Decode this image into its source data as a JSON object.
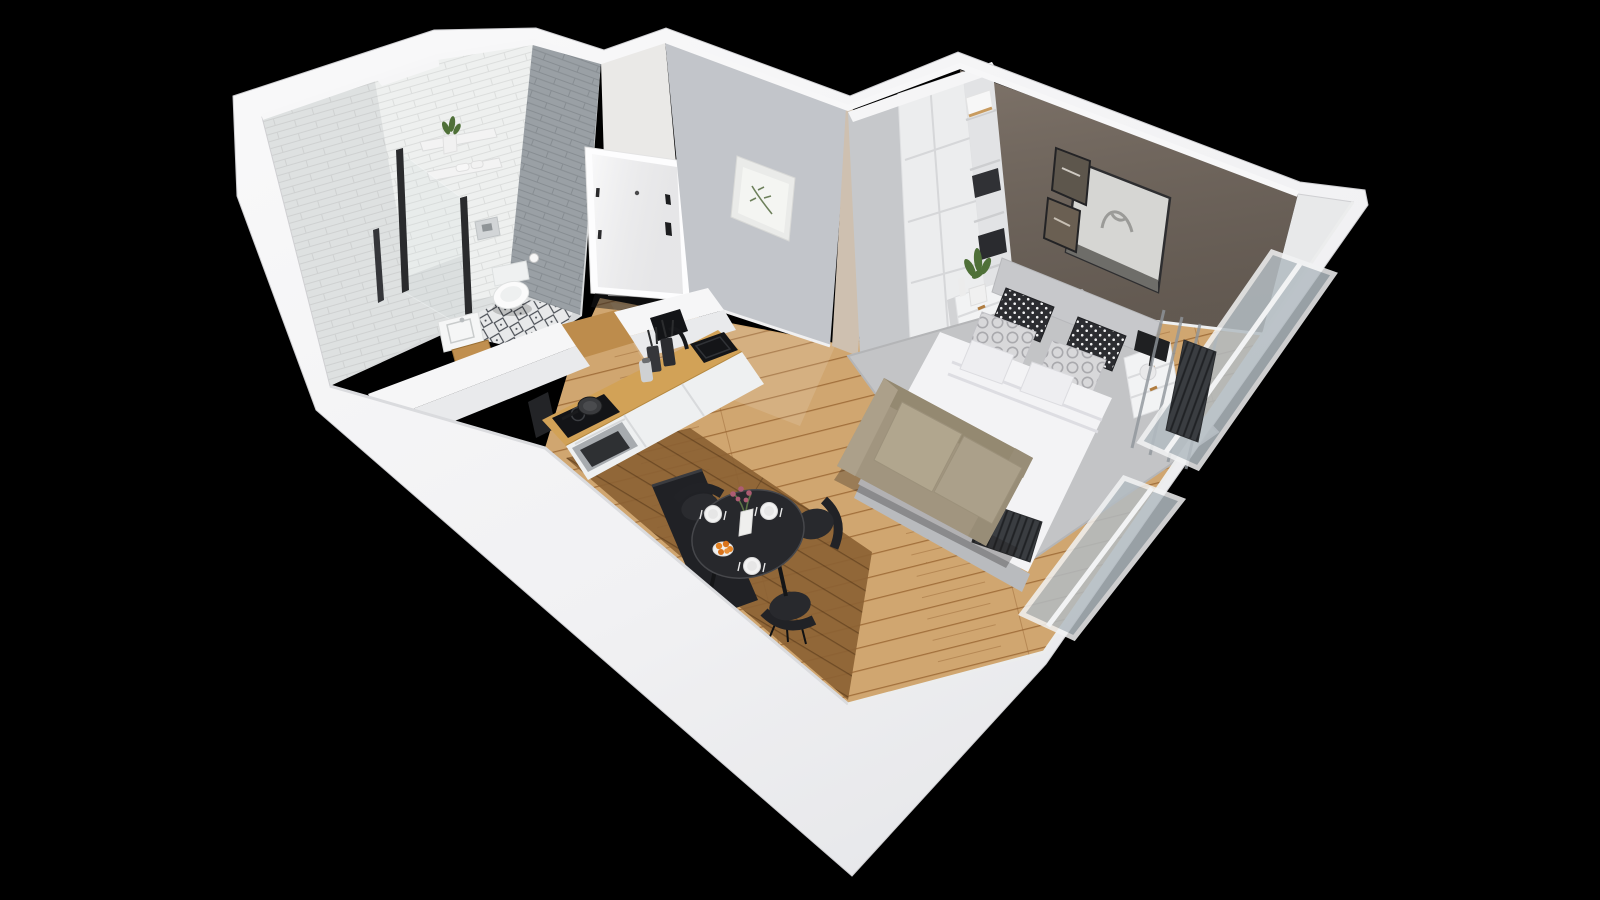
{
  "scene": {
    "title": "3D cutaway floor-plan render of a studio apartment",
    "description": "Isometric bird's-eye 3D render of a small studio apartment with cutaway white walls on a black background: bathroom with walk-in shower and patterned tile floor, entry hall with white entrance door and botanical print, one-wall kitchen with wood countertop, round black dining table set for three, beige loveseat at the foot of a double bed, white wardrobe with open shelving, taupe accent wall with portrait artwork, and a glazed window / balcony wall with radiators.",
    "view": "bird's-eye isometric cutaway",
    "background": "#000000"
  },
  "palette": {
    "background": "#000000",
    "wall_white": "#f4f4f5",
    "wall_shadow": "#dcdde0",
    "hall_wall_gray": "#c2c5ca",
    "hall_wall_white": "#eae9e7",
    "accent_wall_taupe": "#7e7369",
    "accent_strip_beige": "#cec0b0",
    "tile_white": "#eef0ef",
    "tile_gray": "#9aa0a5",
    "bath_floor_tile": "#e8e9ea",
    "bath_floor_pattern": "#474b52",
    "wood_floor": "#d0a670",
    "wood_floor_dark": "#8b6133",
    "counter_wood": "#d2a257",
    "cabinet_white": "#eef0f1",
    "appliance_black": "#131417",
    "steel_gray": "#a7abaf",
    "dining_black": "#27282c",
    "sofa_beige": "#a1957f",
    "bed_duvet_white": "#f3f3f5",
    "headboard_gray": "#c7c8cb",
    "pillow_dark": "#2c2d31",
    "pillow_light": "#d8d8da",
    "rug_gray": "#c3c4c6",
    "plant_green": "#4f7038",
    "orange_fruit": "#e58322",
    "flower_pink": "#ad5c72",
    "window_glass": "#b3bcc2",
    "radiator_dark": "#3a3d41",
    "door_white": "#f5f5f6",
    "hardware_black": "#1c1d1f"
  },
  "rooms": {
    "bathroom": {
      "label": "Bathroom",
      "items": [
        "walk-in shower with glass screen",
        "white subway-tile walls",
        "gray tile wall",
        "wall-hung toilet",
        "flush plate",
        "toilet-paper holder",
        "wall shelves with towels",
        "potted plant",
        "washbasin",
        "wood bench",
        "black-and-white patterned tile floor"
      ]
    },
    "hallway": {
      "label": "Entry hall",
      "items": [
        "white entrance door",
        "black door handle and lock",
        "peephole",
        "framed botanical print",
        "gray feature wall",
        "wood floor"
      ]
    },
    "kitchen": {
      "label": "Kitchen",
      "items": [
        "wood countertop",
        "white base cabinets",
        "black undermount sink",
        "black curved faucet",
        "utensil crocks",
        "induction cooktop with frying pan",
        "built-in oven",
        "dark open niche in half wall"
      ]
    },
    "dining": {
      "label": "Dining nook",
      "items": [
        "round black table",
        "high-back black bench",
        "3 black chairs",
        "3 white plates with cutlery",
        "vase with pink flowers",
        "plate of oranges"
      ]
    },
    "sleeping": {
      "label": "Sleeping / living area",
      "items": [
        "double bed with white duvet",
        "gray upholstered headboard",
        "polka-dot and ring-pattern cushions",
        "two white nightstands",
        "black table lamp",
        "potted plant",
        "tall white wardrobe",
        "open shelving with storage boxes",
        "beige loveseat sofa",
        "gray area rug",
        "large framed portrait artwork",
        "two small picture frames",
        "taupe accent wall"
      ]
    },
    "exterior": {
      "label": "Window / balcony side",
      "items": [
        "floor-to-ceiling glazing",
        "balcony door",
        "white window frames",
        "two dark radiators",
        "white cutaway outer walls"
      ]
    }
  }
}
